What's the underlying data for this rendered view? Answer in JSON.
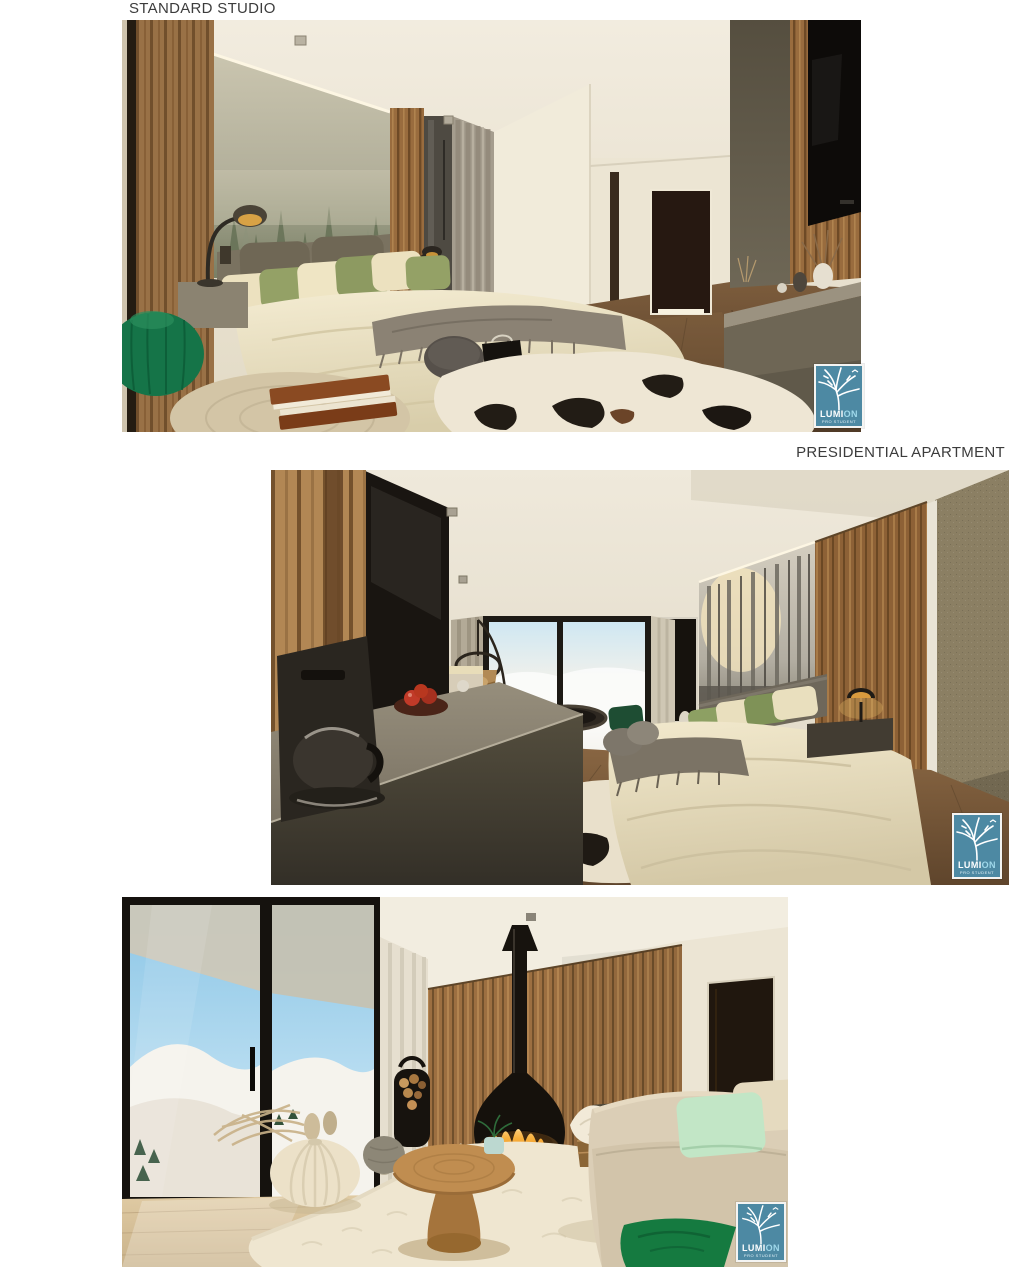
{
  "captions": {
    "standard_studio": "STANDARD STUDIO",
    "presidential_apartment": "PRESIDENTIAL APARTMENT"
  },
  "watermark": {
    "brand_primary": "LUMI",
    "brand_secondary": "ON",
    "subtitle": "PRO STUDENT",
    "box_color": "#4d89a3",
    "accent_text_color": "#9fd8ea"
  },
  "palette": {
    "page_background": "#ffffff",
    "caption_text": "#3c3c3c",
    "wood_tone": "#a57a4c",
    "forest_green": "#667156",
    "pouf_green": "#157448",
    "mint_pillow": "#c2e6c6",
    "fire_orange": "#f08a1e"
  },
  "renders": [
    {
      "name": "standard-studio-bedroom"
    },
    {
      "name": "presidential-apartment-bedroom"
    },
    {
      "name": "presidential-apartment-living-room"
    }
  ]
}
